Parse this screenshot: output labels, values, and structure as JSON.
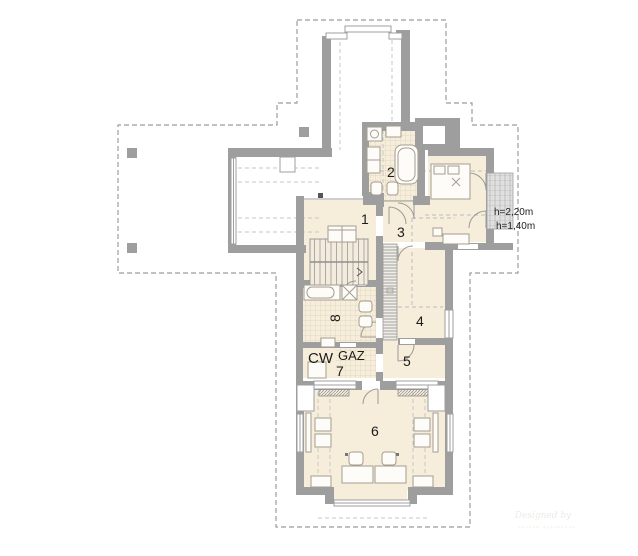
{
  "plan": {
    "type": "floor-plan",
    "rooms": [
      {
        "number": "1"
      },
      {
        "number": "2"
      },
      {
        "number": "3"
      },
      {
        "number": "4"
      },
      {
        "number": "5"
      },
      {
        "number": "6"
      },
      {
        "number": "7"
      },
      {
        "number": "8"
      }
    ],
    "annotations": {
      "cw": "CW",
      "gaz": "GAZ",
      "height_upper": "h=2,20m",
      "height_lower": "h=1,40m"
    },
    "watermark": {
      "line1": "Designed by",
      "line2": "▪▪▪▪▪▪ ▪▪▪▪▪▪▪▪▪"
    },
    "colors": {
      "wall": "#9e9e9e",
      "floor": "#f6edda",
      "tile_line": "#d9cdb4",
      "roof_outline": "#9c9c9c",
      "balcony": "#e0e0e0",
      "text": "#1c1c1c",
      "watermark": "#eceae6"
    }
  }
}
